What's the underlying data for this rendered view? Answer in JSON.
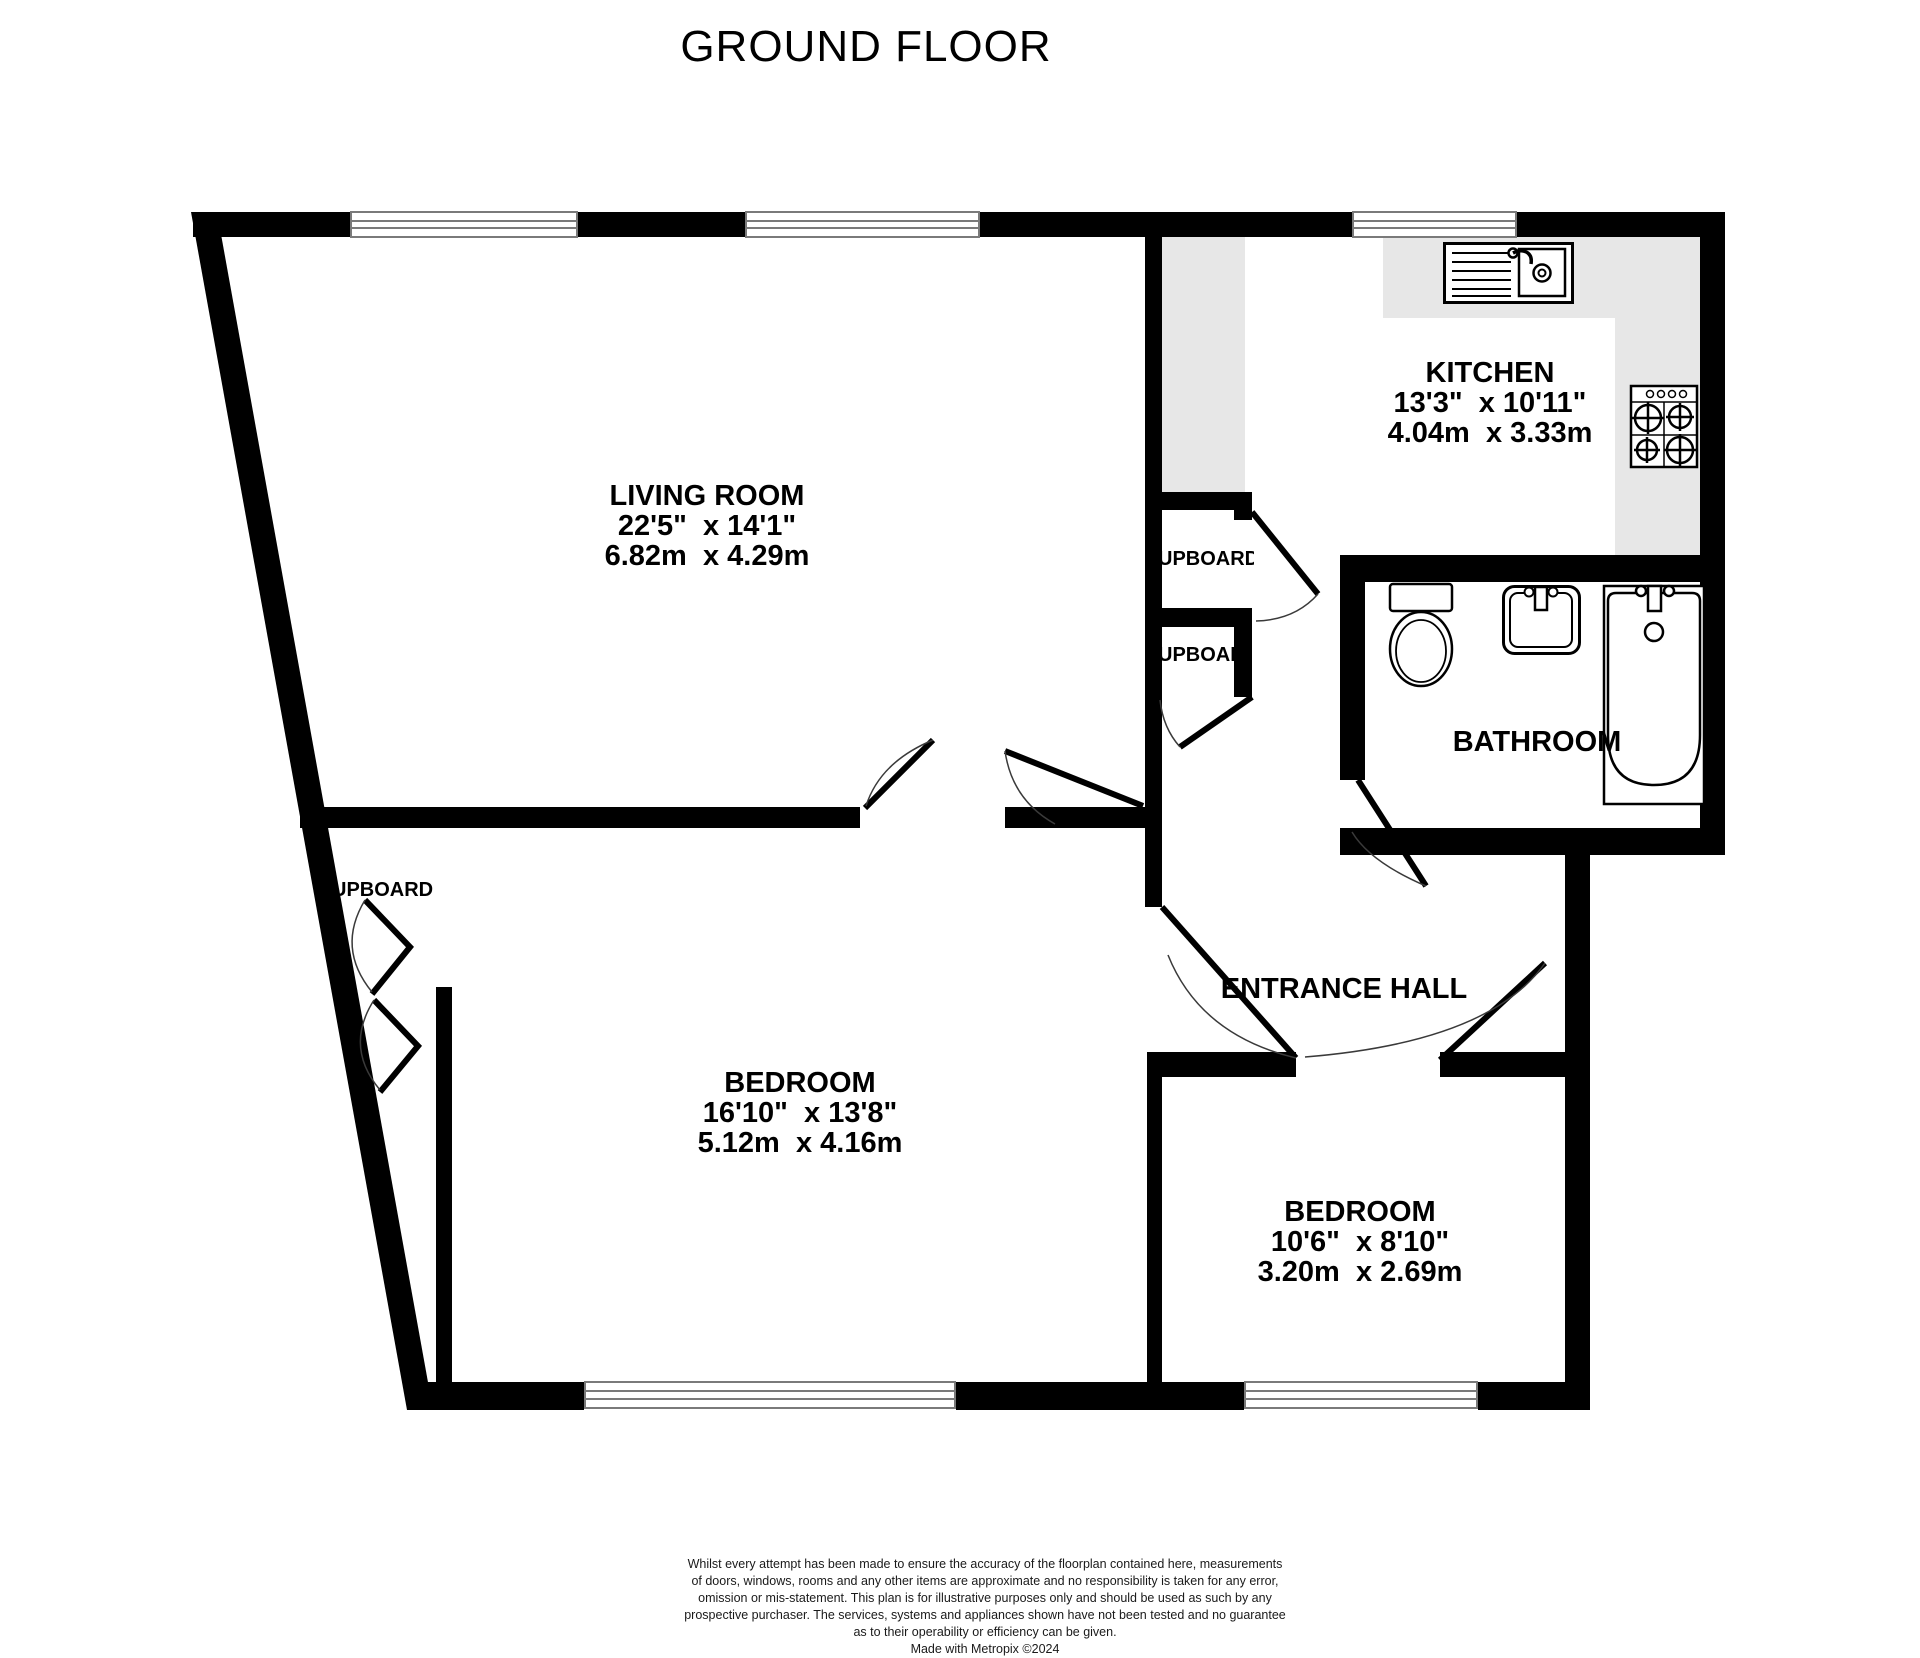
{
  "title": "GROUND FLOOR",
  "colors": {
    "wall": "#000000",
    "counter": "#e7e7e7",
    "winline": "#7a7a7a",
    "arc": "#3a3a3a",
    "text": "#000000"
  },
  "rooms": [
    {
      "id": "living-room",
      "name": "LIVING ROOM",
      "dims_imperial": "22'5\"  x 14'1\"",
      "dims_metric": "6.82m  x 4.29m"
    },
    {
      "id": "kitchen",
      "name": "KITCHEN",
      "dims_imperial": "13'3\"  x 10'11\"",
      "dims_metric": "4.04m  x 3.33m"
    },
    {
      "id": "bathroom",
      "name": "BATHROOM"
    },
    {
      "id": "entrance-hall",
      "name": "ENTRANCE HALL"
    },
    {
      "id": "bedroom-1",
      "name": "BEDROOM",
      "dims_imperial": "16'10\"  x 13'8\"",
      "dims_metric": "5.12m  x 4.16m"
    },
    {
      "id": "bedroom-2",
      "name": "BEDROOM",
      "dims_imperial": "10'6\"  x 8'10\"",
      "dims_metric": "3.20m  x 2.69m"
    }
  ],
  "cupboards": [
    {
      "label": "UPBOARD"
    },
    {
      "label": "UPBOAR"
    },
    {
      "label": "UPBOARD"
    }
  ],
  "icons": {
    "sink": "sink-icon",
    "hob": "hob-icon",
    "toilet": "toilet-icon",
    "basin": "basin-icon",
    "bath": "bathtub-icon",
    "window": "window-symbol",
    "door": "door-swing-icon"
  },
  "footer": {
    "lines": [
      "Whilst every attempt has been made to ensure the accuracy of the floorplan contained here, measurements",
      "of doors, windows, rooms and any other items are approximate and no responsibility is taken for any error,",
      "omission or mis-statement. This plan is for illustrative purposes only and should be used as such by any",
      "prospective purchaser. The services, systems and appliances shown have not been tested and no guarantee",
      "as to their operability or efficiency can be given.",
      "Made with Metropix ©2024"
    ]
  }
}
